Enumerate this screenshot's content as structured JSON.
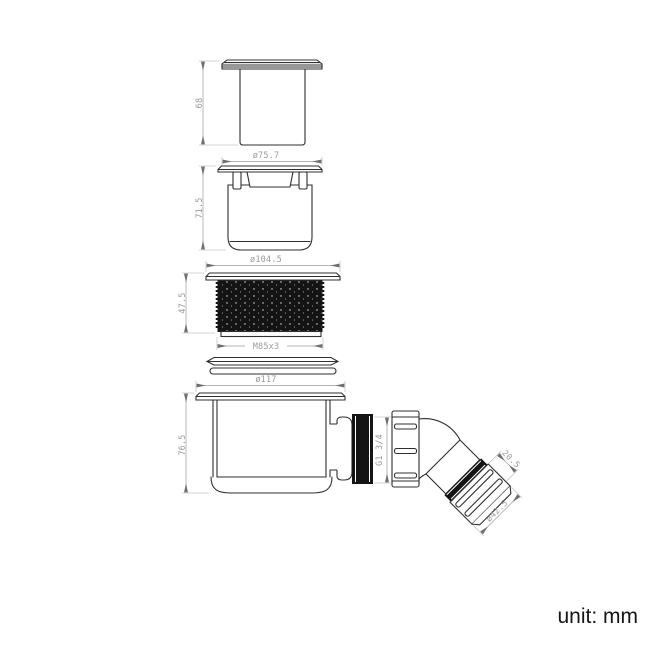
{
  "title": "shower-trap-technical-drawing",
  "unit": {
    "label": "unit: mm"
  },
  "dims": {
    "cap_height": "68",
    "insert_diameter": "ø75.7",
    "insert_height": "71.5",
    "ring_diameter": "ø104.5",
    "ring_height": "47.5",
    "ring_thread": "M85x3",
    "body_diameter": "ø117",
    "body_height": "76.5",
    "outlet_thread": "G1 3/4",
    "elbow_segment_length": "20.5",
    "elbow_nut_diameter": "ø42.5"
  },
  "colors": {
    "ink": "#2f2f2f",
    "dimension_line": "#b3b3b3",
    "dimension_text": "#9b9b9b",
    "thread_fill": "#141414",
    "background": "#ffffff"
  }
}
